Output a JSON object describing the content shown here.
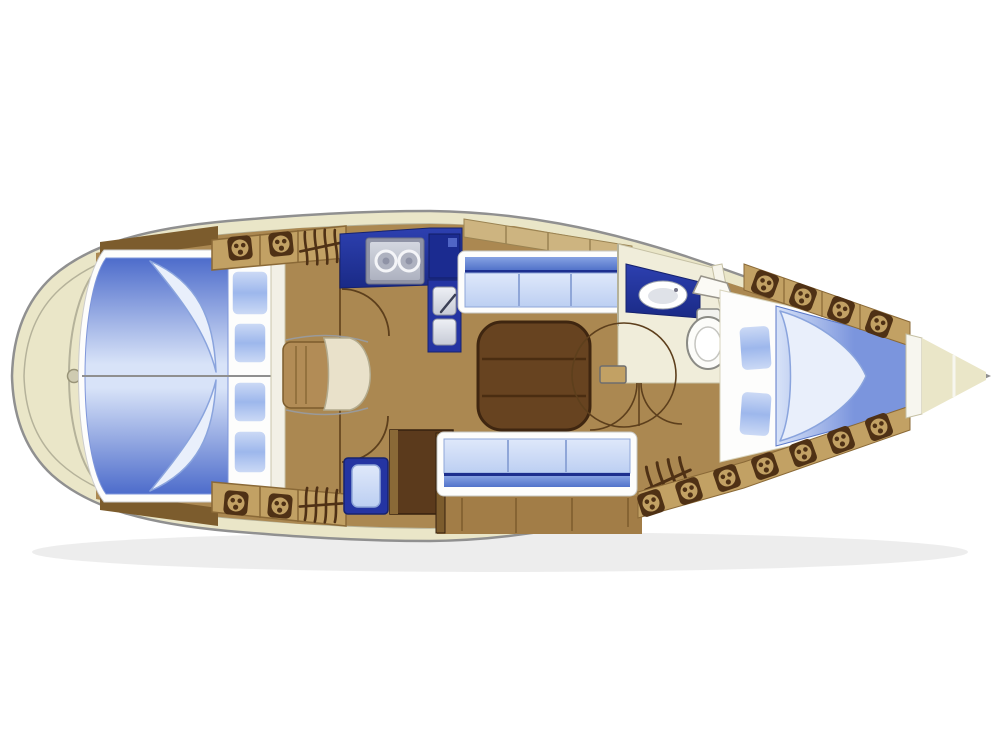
{
  "meta": {
    "canvas_width": 1000,
    "canvas_height": 750,
    "drawing_type": "sailing-yacht-interior-floor-plan"
  },
  "palette": {
    "background": "#ffffff",
    "hull_outline": "#909090",
    "deck": "#eae6c8",
    "deck_line": "#b5b29a",
    "wood_floor": "#ab8851",
    "wood_floor_dark": "#a27d47",
    "wood_dark": "#7c5c2d",
    "wood_strip": "#8a6937",
    "desk_brown": "#5b3a1c",
    "desk_edge": "#36210e",
    "table_brown": "#674320",
    "table_edge": "#3f2610",
    "table_line": "#4a2d11",
    "locker_tan": "#c2a164",
    "locker_face": "#cdb480",
    "symbol_brown": "#4f3115",
    "door_arc": "#5d3f1c",
    "navy": "#2434a2",
    "navy_dark": "#16226e",
    "navy_hi": "#2d40b0",
    "navy_lo": "#1a2a86",
    "steel_light": "#d4d7e0",
    "steel": "#aeb2c0",
    "steel_frame": "#8f93a6",
    "steel_dark": "#6e7285",
    "bed_blue": "#4d6ccb",
    "bed_mid": "#7b95dd",
    "bed_light": "#d8e3f8",
    "quilt_fill": "#e9effb",
    "quilt_line": "#8aa4dd",
    "pillow_blue": "#9db7ec",
    "pillow_hi": "#cfdcf6",
    "cushion_light": "#dfe8fa",
    "cushion_mid": "#bccff2",
    "cushion_band": "#5273ca",
    "band_hi": "#86a2e2",
    "cushion_line": "#1d2f8e",
    "cushion_divider": "#8fa6d8",
    "white": "#fdfdfc",
    "cream": "#f0edda",
    "cream_line": "#c5c0a4",
    "chair_cream": "#e9e1ca",
    "chair_tan": "#b28c56",
    "fixture_line": "#8b8b85",
    "sink_hi": "#eef0f5",
    "sink_lo": "#c6cad6",
    "shadow": "rgba(0,0,0,0.07)"
  },
  "icons": {
    "hatch_locker": "square-with-three-dots",
    "vent_louver": "four-hatched-lines-crossed",
    "stove": "two-burner-circles",
    "galley_sink": "double-square-basins",
    "head_sink": "oval-basin",
    "toilet": "bowl-with-tank",
    "door_swing": "quarter-circle-arc"
  },
  "regions": [
    "stern-deck",
    "aft-double-berth",
    "nav-station",
    "galley",
    "saloon",
    "head",
    "fore-cabin-v-berth",
    "anchor-locker"
  ]
}
